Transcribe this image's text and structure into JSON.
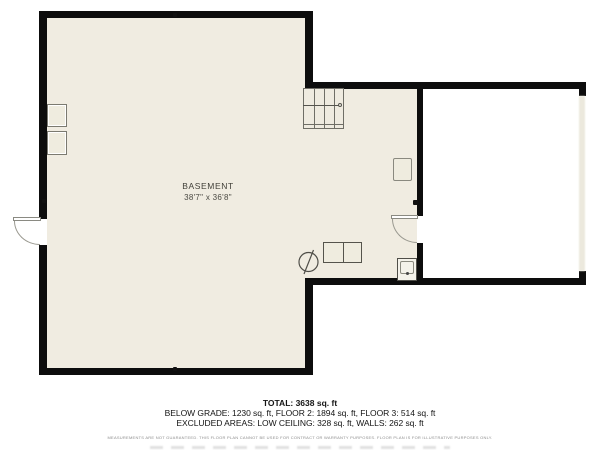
{
  "plan": {
    "room": {
      "name": "BASEMENT",
      "dimensions": "38'7\" x 36'8\""
    },
    "symbols": [
      "stairs",
      "exterior-door",
      "interior-door",
      "sump-pump",
      "utility-units",
      "water-heater",
      "window-boxes"
    ]
  },
  "summary": {
    "total": "TOTAL: 3638 sq. ft",
    "breakdown": "BELOW GRADE: 1230 sq. ft, FLOOR 2: 1894 sq. ft, FLOOR 3: 514 sq. ft",
    "excluded": "EXCLUDED AREAS: LOW CEILING: 328 sq. ft, WALLS: 262 sq. ft",
    "disclaimer": "MEASUREMENTS ARE NOT GUARANTEED. THIS FLOOR PLAN CANNOT BE USED FOR CONTRACT OR WARRANTY PURPOSES. FLOOR PLAN IS FOR ILLUSTRATIVE PURPOSES ONLY."
  },
  "colors": {
    "wall": "#0d0d0d",
    "floor": "#f0ece1",
    "outside": "#ffffff",
    "fixture_outline": "#6f6e66",
    "label_text": "#403f38",
    "open_edge": "#ece9dd"
  }
}
